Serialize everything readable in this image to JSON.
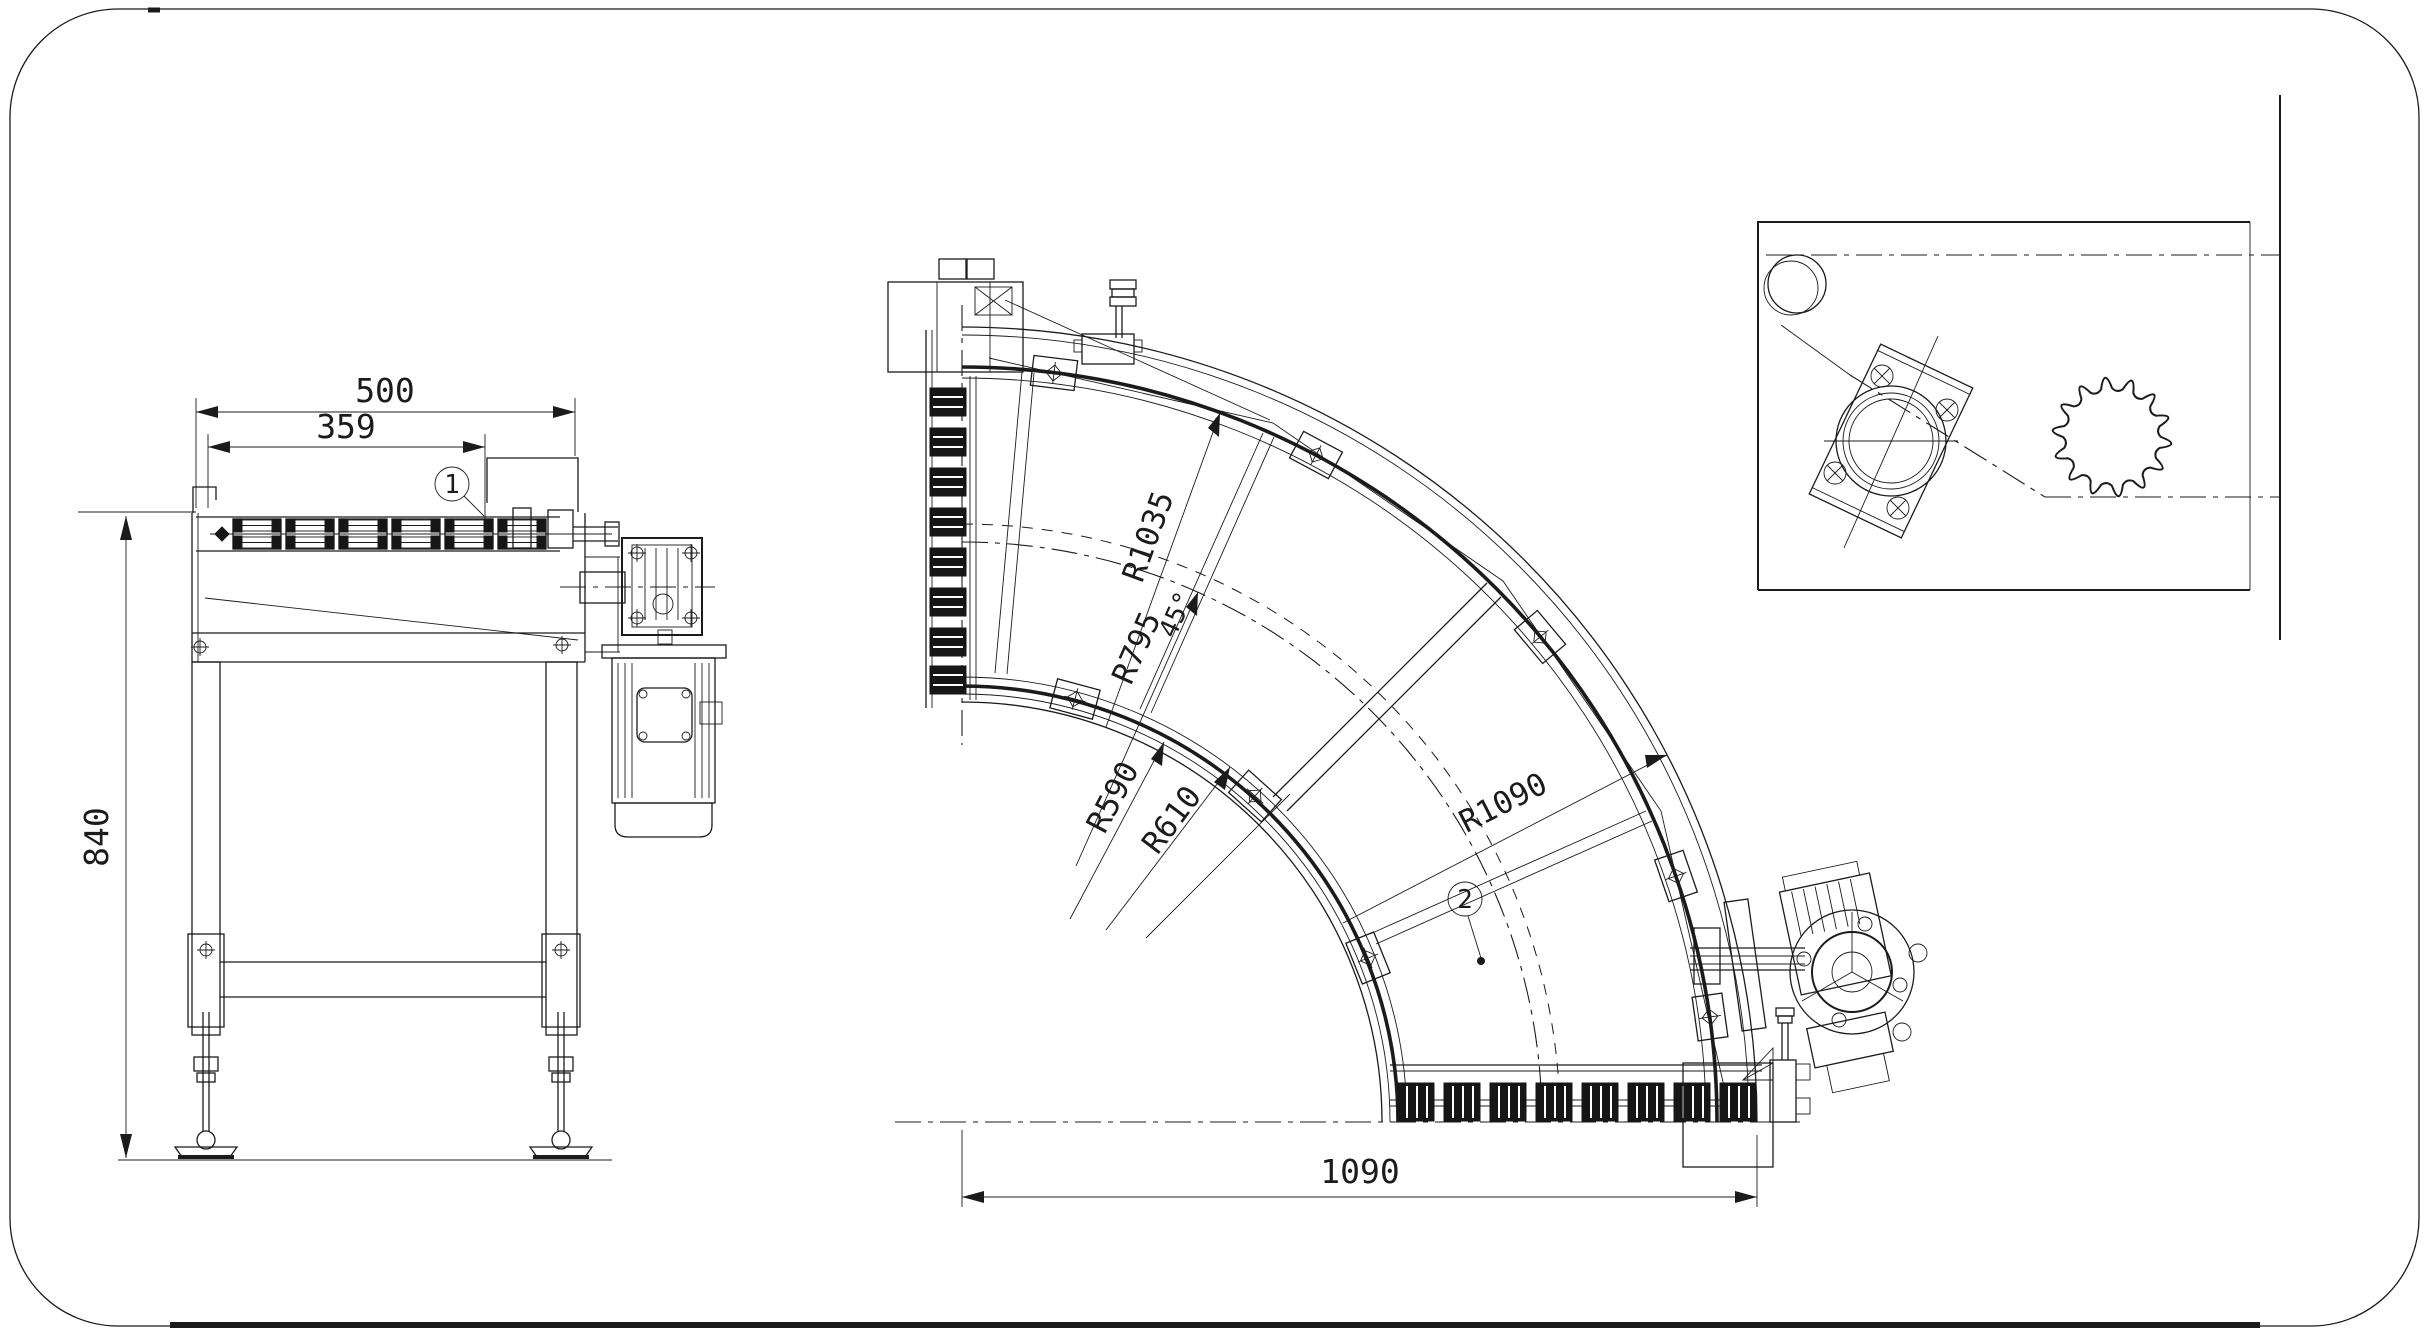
{
  "colors": {
    "ink": "#1b1b1b",
    "background": "#ffffff"
  },
  "side_view": {
    "dim_total_width": "500",
    "dim_chain_width": "359",
    "dim_height": "840",
    "balloon": "1"
  },
  "plan_view": {
    "dim_radius_outer_guide": "R1035",
    "dim_radius_pitch": "R795",
    "dim_angle": "45°",
    "dim_radius_inner_edge": "R590",
    "dim_radius_inner_guide": "R610",
    "dim_radius_outer_edge": "R1090",
    "dim_bottom_width": "1090",
    "balloon": "2"
  }
}
